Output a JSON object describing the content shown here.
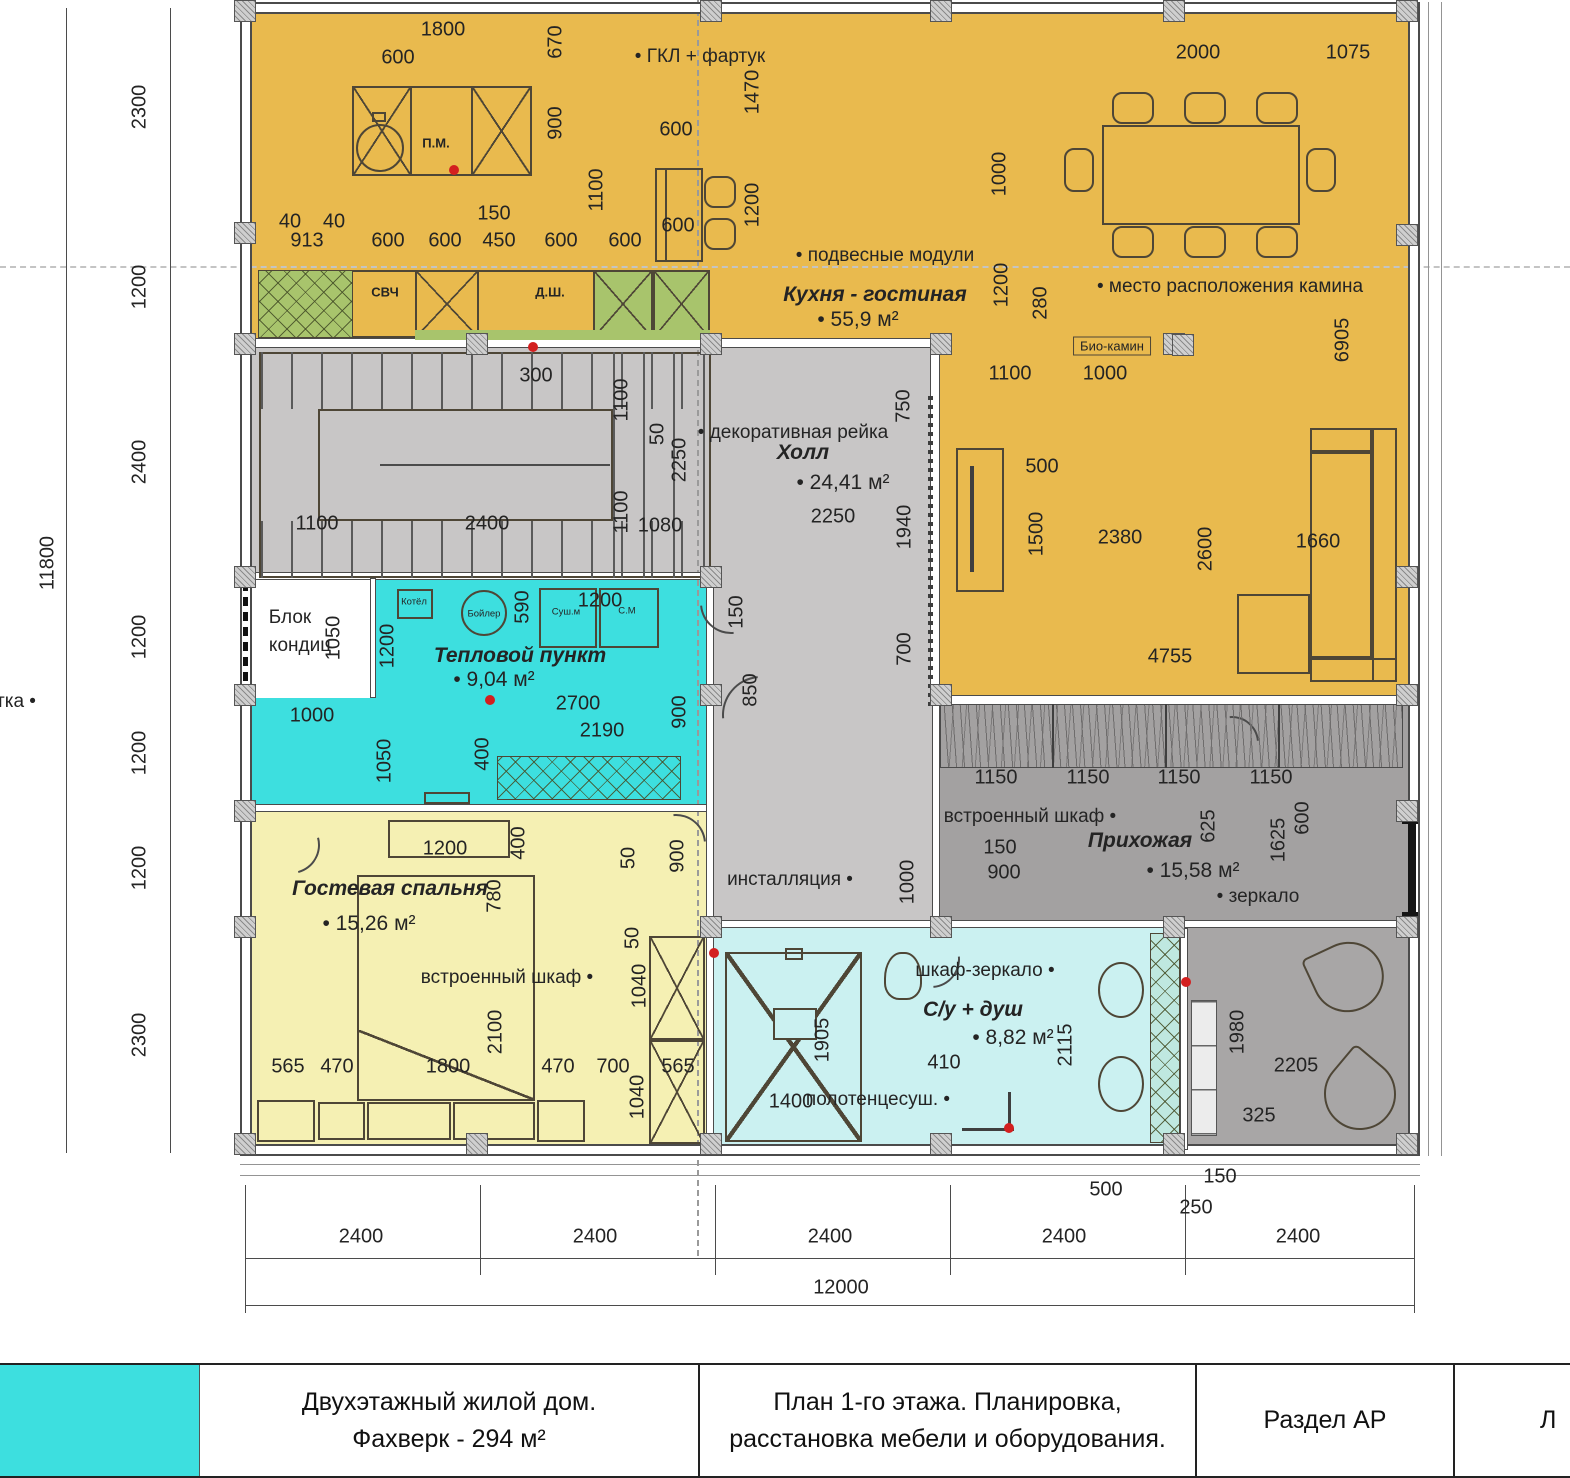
{
  "drawing": {
    "type": "floor-plan",
    "building": "Двухэтажный жилой дом. Фахверк - 294 м²",
    "floor": "План 1-го этажа",
    "overall_width_mm": 12000,
    "overall_depth_mm": 11800
  },
  "rooms": [
    {
      "name": "Кухня - гостиная",
      "area": "55,9 м²",
      "color": "#e9ba4e"
    },
    {
      "name": "Холл",
      "area": "24,41 м²",
      "color": "#c8c6c6"
    },
    {
      "name": "Тепловой пункт",
      "area": "9,04 м²",
      "color": "#3ddfdf"
    },
    {
      "name": "Гостевая спальня",
      "area": "15,26 м²",
      "color": "#f5f0b3"
    },
    {
      "name": "Прихожая",
      "area": "15,58 м²",
      "color": "#a3a1a1"
    },
    {
      "name": "С/у + душ",
      "area": "8,82 м²",
      "color": "#cbf1f1"
    }
  ],
  "equipment_labels": [
    "ГКЛ + фартук",
    "подвесные модули",
    "место расположения камина",
    "Био-камин",
    "декоративная рейка",
    "Блок кондиц",
    "встроенный шкаф",
    "инсталляция",
    "шкаф-зеркало",
    "полотенцесуш.",
    "зеркало",
    "СВЧ",
    "Д.Ш.",
    "П.М.",
    "Котёл",
    "Бойлер",
    "Суш.м",
    "С.М"
  ],
  "title_block": {
    "project_line1": "Двухэтажный жилой дом.",
    "project_line2": "Фахверк - 294 м²",
    "sheet_line1": "План 1-го этажа. Планировка,",
    "sheet_line2": "расстановка мебели и оборудования.",
    "section": "Раздел АР",
    "sheet_label": "Л"
  },
  "plan_texts": [
    {
      "t": "11800",
      "x": 48,
      "y": 563,
      "s": "d",
      "v": 1
    },
    {
      "t": "2300",
      "x": 140,
      "y": 107,
      "s": "d",
      "v": 1
    },
    {
      "t": "1200",
      "x": 140,
      "y": 287,
      "s": "d",
      "v": 1
    },
    {
      "t": "2400",
      "x": 140,
      "y": 462,
      "s": "d",
      "v": 1
    },
    {
      "t": "1200",
      "x": 140,
      "y": 637,
      "s": "d",
      "v": 1
    },
    {
      "t": "1200",
      "x": 140,
      "y": 753,
      "s": "d",
      "v": 1
    },
    {
      "t": "1200",
      "x": 140,
      "y": 868,
      "s": "d",
      "v": 1
    },
    {
      "t": "2300",
      "x": 140,
      "y": 1035,
      "s": "d",
      "v": 1
    },
    {
      "t": "1800",
      "x": 443,
      "y": 30,
      "s": "d"
    },
    {
      "t": "600",
      "x": 398,
      "y": 58,
      "s": "d"
    },
    {
      "t": "670",
      "x": 556,
      "y": 42,
      "s": "d",
      "v": 1
    },
    {
      "t": "900",
      "x": 556,
      "y": 123,
      "s": "d",
      "v": 1
    },
    {
      "t": "1100",
      "x": 597,
      "y": 190,
      "s": "d",
      "v": 1
    },
    {
      "t": "ГКЛ + фартук",
      "x": 700,
      "y": 57,
      "s": "l",
      "n": "label-gkl-fartuk"
    },
    {
      "t": "1470",
      "x": 753,
      "y": 92,
      "s": "d",
      "v": 1
    },
    {
      "t": "600",
      "x": 676,
      "y": 130,
      "s": "d"
    },
    {
      "t": "600",
      "x": 678,
      "y": 226,
      "s": "d"
    },
    {
      "t": "1200",
      "x": 753,
      "y": 205,
      "s": "d",
      "v": 1
    },
    {
      "t": "150",
      "x": 494,
      "y": 214,
      "s": "d"
    },
    {
      "t": "40",
      "x": 290,
      "y": 222,
      "s": "d"
    },
    {
      "t": "40",
      "x": 334,
      "y": 222,
      "s": "d"
    },
    {
      "t": "913",
      "x": 307,
      "y": 241,
      "s": "d"
    },
    {
      "t": "600",
      "x": 388,
      "y": 241,
      "s": "d"
    },
    {
      "t": "600",
      "x": 445,
      "y": 241,
      "s": "d"
    },
    {
      "t": "450",
      "x": 499,
      "y": 241,
      "s": "d"
    },
    {
      "t": "600",
      "x": 561,
      "y": 241,
      "s": "d"
    },
    {
      "t": "600",
      "x": 625,
      "y": 241,
      "s": "d"
    },
    {
      "t": "П.М.",
      "x": 436,
      "y": 143,
      "s": "m",
      "n": "label-dishwasher"
    },
    {
      "t": "СВЧ",
      "x": 385,
      "y": 292,
      "s": "m",
      "n": "label-microwave"
    },
    {
      "t": "Д.Ш.",
      "x": 550,
      "y": 292,
      "s": "m",
      "n": "label-dsh"
    },
    {
      "t": "подвесные модули",
      "x": 885,
      "y": 256,
      "s": "l",
      "n": "label-hanging-modules"
    },
    {
      "t": "Кухня - гостиная",
      "x": 875,
      "y": 295,
      "s": "r",
      "n": "room-label-kitchen-living"
    },
    {
      "t": "55,9 м²",
      "x": 858,
      "y": 320,
      "s": "a",
      "n": "area-kitchen-living"
    },
    {
      "t": "1000",
      "x": 1000,
      "y": 174,
      "s": "d",
      "v": 1
    },
    {
      "t": "1200",
      "x": 1002,
      "y": 285,
      "s": "d",
      "v": 1
    },
    {
      "t": "280",
      "x": 1041,
      "y": 303,
      "s": "d",
      "v": 1
    },
    {
      "t": "место расположения камина",
      "x": 1230,
      "y": 287,
      "s": "l",
      "n": "label-fireplace-location"
    },
    {
      "t": "2000",
      "x": 1198,
      "y": 53,
      "s": "d"
    },
    {
      "t": "1075",
      "x": 1348,
      "y": 53,
      "s": "d"
    },
    {
      "t": "6905",
      "x": 1343,
      "y": 340,
      "s": "d",
      "v": 1
    },
    {
      "t": "1100",
      "x": 1010,
      "y": 374,
      "s": "d"
    },
    {
      "t": "1000",
      "x": 1105,
      "y": 374,
      "s": "d"
    },
    {
      "t": "Био-камин",
      "x": 1112,
      "y": 346,
      "s": "bx",
      "n": "label-bio-fireplace"
    },
    {
      "t": "500",
      "x": 1042,
      "y": 467,
      "s": "d"
    },
    {
      "t": "1500",
      "x": 1037,
      "y": 534,
      "s": "d",
      "v": 1
    },
    {
      "t": "2380",
      "x": 1120,
      "y": 538,
      "s": "d"
    },
    {
      "t": "2600",
      "x": 1206,
      "y": 549,
      "s": "d",
      "v": 1
    },
    {
      "t": "1660",
      "x": 1318,
      "y": 542,
      "s": "d"
    },
    {
      "t": "4755",
      "x": 1170,
      "y": 657,
      "s": "d"
    },
    {
      "t": "300",
      "x": 536,
      "y": 376,
      "s": "d"
    },
    {
      "t": "1100",
      "x": 622,
      "y": 400,
      "s": "d",
      "v": 1
    },
    {
      "t": "50",
      "x": 658,
      "y": 434,
      "s": "d",
      "v": 1
    },
    {
      "t": "2250",
      "x": 680,
      "y": 460,
      "s": "d",
      "v": 1
    },
    {
      "t": "1100",
      "x": 622,
      "y": 512,
      "s": "d",
      "v": 1
    },
    {
      "t": "1100",
      "x": 317,
      "y": 524,
      "s": "d"
    },
    {
      "t": "2400",
      "x": 487,
      "y": 524,
      "s": "d"
    },
    {
      "t": "1080",
      "x": 660,
      "y": 526,
      "s": "d"
    },
    {
      "t": "декоративная рейка",
      "x": 793,
      "y": 433,
      "s": "l",
      "n": "label-decorative-rail"
    },
    {
      "t": "Холл",
      "x": 803,
      "y": 453,
      "s": "r",
      "n": "room-label-hall"
    },
    {
      "t": "24,41 м²",
      "x": 843,
      "y": 483,
      "s": "a",
      "n": "area-hall"
    },
    {
      "t": "2250",
      "x": 833,
      "y": 517,
      "s": "d"
    },
    {
      "t": "750",
      "x": 904,
      "y": 406,
      "s": "d",
      "v": 1
    },
    {
      "t": "1940",
      "x": 905,
      "y": 527,
      "s": "d",
      "v": 1
    },
    {
      "t": "700",
      "x": 905,
      "y": 649,
      "s": "d",
      "v": 1
    },
    {
      "t": "150",
      "x": 737,
      "y": 612,
      "s": "d",
      "v": 1
    },
    {
      "t": "850",
      "x": 751,
      "y": 690,
      "s": "d",
      "v": 1
    },
    {
      "t": "900",
      "x": 680,
      "y": 712,
      "s": "d",
      "v": 1
    },
    {
      "t": "Блок",
      "x": 290,
      "y": 618,
      "s": "p",
      "n": "label-ac-block-1"
    },
    {
      "t": "кондиц",
      "x": 300,
      "y": 646,
      "s": "p",
      "n": "label-ac-block-2"
    },
    {
      "t": "1050",
      "x": 334,
      "y": 638,
      "s": "d",
      "v": 1
    },
    {
      "t": "1200",
      "x": 388,
      "y": 646,
      "s": "d",
      "v": 1
    },
    {
      "t": "590",
      "x": 523,
      "y": 607,
      "s": "d",
      "v": 1
    },
    {
      "t": "1200",
      "x": 600,
      "y": 601,
      "s": "d"
    },
    {
      "t": "Котёл",
      "x": 414,
      "y": 602,
      "s": "t",
      "n": "label-boiler-unit"
    },
    {
      "t": "Бойлер",
      "x": 484,
      "y": 614,
      "s": "t",
      "n": "label-water-heater"
    },
    {
      "t": "Суш.м",
      "x": 566,
      "y": 612,
      "s": "t",
      "n": "label-dryer"
    },
    {
      "t": "С.М",
      "x": 627,
      "y": 611,
      "s": "t",
      "n": "label-washer"
    },
    {
      "t": "Тепловой пункт",
      "x": 520,
      "y": 656,
      "s": "r",
      "n": "room-label-heat-point"
    },
    {
      "t": "9,04 м²",
      "x": 494,
      "y": 680,
      "s": "a",
      "n": "area-heat-point"
    },
    {
      "t": "2700",
      "x": 578,
      "y": 704,
      "s": "d"
    },
    {
      "t": "2190",
      "x": 602,
      "y": 731,
      "s": "d"
    },
    {
      "t": "1000",
      "x": 312,
      "y": 716,
      "s": "d"
    },
    {
      "t": "1050",
      "x": 385,
      "y": 761,
      "s": "d",
      "v": 1
    },
    {
      "t": "400",
      "x": 483,
      "y": 754,
      "s": "d",
      "v": 1
    },
    {
      "t": "тка",
      "x": 16,
      "y": 702,
      "s": "lr",
      "n": "label-cut-left"
    },
    {
      "t": "инсталляция",
      "x": 790,
      "y": 880,
      "s": "lr",
      "n": "label-installation"
    },
    {
      "t": "1000",
      "x": 908,
      "y": 882,
      "s": "d",
      "v": 1
    },
    {
      "t": "1200",
      "x": 445,
      "y": 849,
      "s": "d"
    },
    {
      "t": "400",
      "x": 519,
      "y": 843,
      "s": "d",
      "v": 1
    },
    {
      "t": "780",
      "x": 495,
      "y": 896,
      "s": "d",
      "v": 1
    },
    {
      "t": "Гостевая спальня",
      "x": 390,
      "y": 889,
      "s": "r",
      "n": "room-label-guest-bedroom"
    },
    {
      "t": "15,26 м²",
      "x": 369,
      "y": 924,
      "s": "a",
      "n": "area-guest-bedroom"
    },
    {
      "t": "50",
      "x": 629,
      "y": 858,
      "s": "d",
      "v": 1
    },
    {
      "t": "900",
      "x": 678,
      "y": 856,
      "s": "d",
      "v": 1
    },
    {
      "t": "50",
      "x": 633,
      "y": 938,
      "s": "d",
      "v": 1
    },
    {
      "t": "1040",
      "x": 640,
      "y": 986,
      "s": "d",
      "v": 1
    },
    {
      "t": "встроенный шкаф",
      "x": 507,
      "y": 978,
      "s": "lr",
      "n": "label-builtin-wardrobe-bedroom"
    },
    {
      "t": "2100",
      "x": 496,
      "y": 1032,
      "s": "d",
      "v": 1
    },
    {
      "t": "565",
      "x": 288,
      "y": 1067,
      "s": "d"
    },
    {
      "t": "470",
      "x": 337,
      "y": 1067,
      "s": "d"
    },
    {
      "t": "1800",
      "x": 448,
      "y": 1067,
      "s": "d"
    },
    {
      "t": "470",
      "x": 558,
      "y": 1067,
      "s": "d"
    },
    {
      "t": "700",
      "x": 613,
      "y": 1067,
      "s": "d"
    },
    {
      "t": "565",
      "x": 678,
      "y": 1067,
      "s": "d"
    },
    {
      "t": "1040",
      "x": 638,
      "y": 1097,
      "s": "d",
      "v": 1
    },
    {
      "t": "шкаф-зеркало",
      "x": 985,
      "y": 971,
      "s": "lr",
      "n": "label-mirror-cabinet"
    },
    {
      "t": "С/у + душ",
      "x": 973,
      "y": 1010,
      "s": "r",
      "n": "room-label-bathroom"
    },
    {
      "t": "8,82 м²",
      "x": 1013,
      "y": 1038,
      "s": "a",
      "n": "area-bathroom"
    },
    {
      "t": "410",
      "x": 944,
      "y": 1063,
      "s": "d"
    },
    {
      "t": "1905",
      "x": 823,
      "y": 1040,
      "s": "d",
      "v": 1
    },
    {
      "t": "1400",
      "x": 791,
      "y": 1102,
      "s": "d"
    },
    {
      "t": "полотенцесуш.",
      "x": 878,
      "y": 1100,
      "s": "lr",
      "n": "label-towel-rail"
    },
    {
      "t": "2115",
      "x": 1066,
      "y": 1045,
      "s": "d",
      "v": 1
    },
    {
      "t": "500",
      "x": 1106,
      "y": 1190,
      "s": "d"
    },
    {
      "t": "250",
      "x": 1196,
      "y": 1208,
      "s": "d"
    },
    {
      "t": "150",
      "x": 1220,
      "y": 1177,
      "s": "d"
    },
    {
      "t": "1150",
      "x": 996,
      "y": 778,
      "s": "d"
    },
    {
      "t": "1150",
      "x": 1088,
      "y": 778,
      "s": "d"
    },
    {
      "t": "1150",
      "x": 1179,
      "y": 778,
      "s": "d"
    },
    {
      "t": "1150",
      "x": 1271,
      "y": 778,
      "s": "d"
    },
    {
      "t": "встроенный шкаф",
      "x": 1030,
      "y": 817,
      "s": "lr",
      "n": "label-builtin-wardrobe-entry"
    },
    {
      "t": "Прихожая",
      "x": 1140,
      "y": 841,
      "s": "r",
      "n": "room-label-entry"
    },
    {
      "t": "15,58 м²",
      "x": 1193,
      "y": 871,
      "s": "a",
      "n": "area-entry"
    },
    {
      "t": "625",
      "x": 1209,
      "y": 826,
      "s": "d",
      "v": 1
    },
    {
      "t": "1625",
      "x": 1279,
      "y": 840,
      "s": "d",
      "v": 1
    },
    {
      "t": "600",
      "x": 1303,
      "y": 818,
      "s": "d",
      "v": 1
    },
    {
      "t": "150",
      "x": 1000,
      "y": 848,
      "s": "d"
    },
    {
      "t": "900",
      "x": 1004,
      "y": 873,
      "s": "d"
    },
    {
      "t": "зеркало",
      "x": 1258,
      "y": 897,
      "s": "l",
      "n": "label-mirror"
    },
    {
      "t": "1980",
      "x": 1238,
      "y": 1032,
      "s": "d",
      "v": 1
    },
    {
      "t": "2205",
      "x": 1296,
      "y": 1066,
      "s": "d"
    },
    {
      "t": "325",
      "x": 1259,
      "y": 1116,
      "s": "d"
    },
    {
      "t": "2400",
      "x": 361,
      "y": 1237,
      "s": "d"
    },
    {
      "t": "2400",
      "x": 595,
      "y": 1237,
      "s": "d"
    },
    {
      "t": "2400",
      "x": 830,
      "y": 1237,
      "s": "d"
    },
    {
      "t": "2400",
      "x": 1064,
      "y": 1237,
      "s": "d"
    },
    {
      "t": "2400",
      "x": 1298,
      "y": 1237,
      "s": "d"
    },
    {
      "t": "12000",
      "x": 841,
      "y": 1288,
      "s": "d"
    }
  ]
}
